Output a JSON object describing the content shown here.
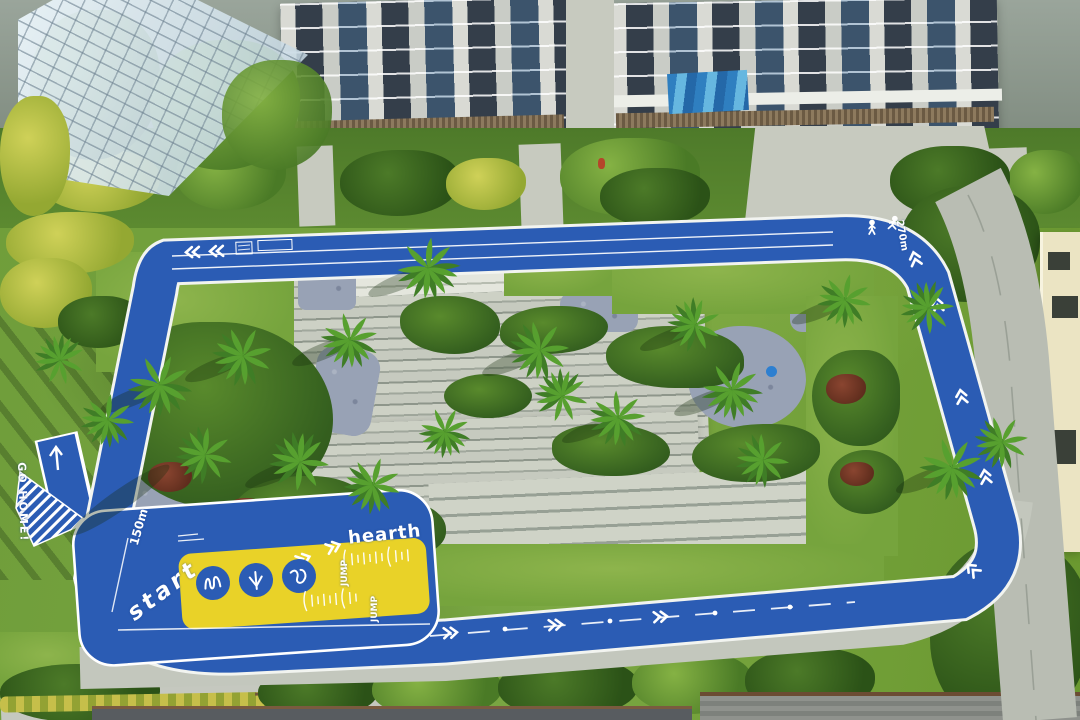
{
  "photo": {
    "description": "Aerial drone view of a residential courtyard garden with a blue jogging track loop, yellow fitness zone, palm trees, paver plaza and apartment towers",
    "track": {
      "hearth_label": "hearth",
      "start_label": "start",
      "go_home_label": "GO HOME!",
      "jump_label_top": "JUMP",
      "jump_label_bottom": "JUMP",
      "marker_150": "150m",
      "marker_270": "270m"
    },
    "icons": [
      "walking-person-icon",
      "running-person-icon",
      "squiggle-path-icon",
      "triple-arrow-down-icon",
      "wave-path-icon",
      "chevron-arrows",
      "go-home-up-arrow"
    ],
    "colors": {
      "track_blue": "#2b5cb4",
      "zone_yellow": "#e9d228",
      "line_white": "#ffffff",
      "grass_green": "#6f9d3a",
      "paver_gray": "#cdd1c5",
      "gravel_blue_gray": "#98a2b5"
    }
  }
}
